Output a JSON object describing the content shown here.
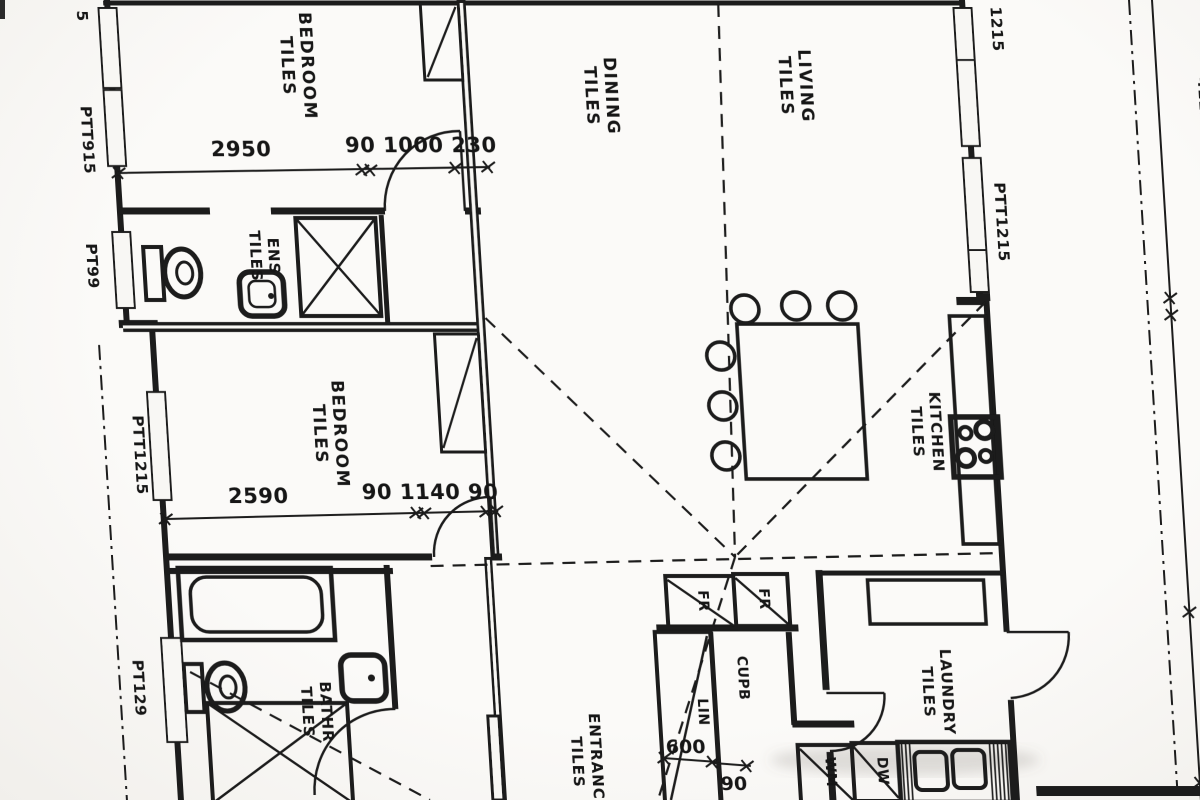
{
  "colors": {
    "ink": "#1a1a1a",
    "paper": "#f8f7f4"
  },
  "rooms": {
    "bedroom1": {
      "name": "BEDROOM",
      "finish": "TILES"
    },
    "dining": {
      "name": "DINING",
      "finish": "TILES"
    },
    "living": {
      "name": "LIVING",
      "finish": "TILES"
    },
    "kitchen": {
      "name": "KITCHEN",
      "finish": "TILES"
    },
    "bedroom2": {
      "name": "BEDROOM",
      "finish": "TILES"
    },
    "ensuite": {
      "name": "ENS",
      "finish": "TILES"
    },
    "bathroom": {
      "name": "BATHR",
      "finish": "TILES"
    },
    "entrance": {
      "name": "ENTRANCE",
      "finish": "TILES"
    },
    "laundry": {
      "name": "LAUNDRY",
      "finish": "TILES"
    }
  },
  "fixtures": {
    "fridge1": "FR",
    "fridge2": "FR",
    "cupboard": "CUPB",
    "linen": "LIN",
    "washing_machine": "WM",
    "dishwasher": "DW"
  },
  "windows": {
    "top_left_fragment": "5",
    "left1": "PTT915",
    "left2": "PT99",
    "left3": "PTT1215",
    "left4": "PT129",
    "right_top_fragment": "1215",
    "right1": "PTT1215",
    "far_right_partial": "4115"
  },
  "dimensions": {
    "bedroom1_width": "2950",
    "bedroom1_door": "90 1000 230",
    "bedroom2_width": "2590",
    "bedroom2_door": "90 1140 90",
    "linen_width": "600",
    "linen_wall": "90"
  }
}
